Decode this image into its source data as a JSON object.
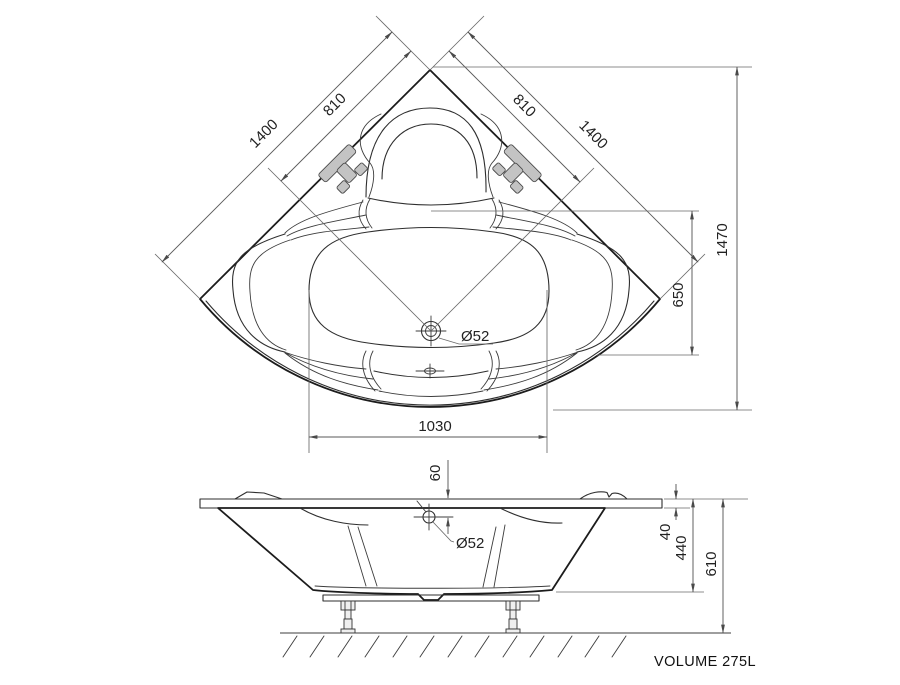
{
  "drawing": {
    "title": "corner bathtub technical drawing",
    "top_view": {
      "dim_edge_full": "1400",
      "dim_edge_drain": "810",
      "dim_overall_depth": "1470",
      "dim_drain_vertical": "650",
      "dim_basin_width": "1030",
      "drain_diameter": "Ø52"
    },
    "side_view": {
      "dim_drain_drop": "60",
      "drain_diameter": "Ø52",
      "dim_rim_thickness": "40",
      "dim_shell_height": "440",
      "dim_total_height": "610",
      "volume_label": "VOLUME 275L"
    },
    "colors": {
      "shell_fill": "#e8eaea",
      "outline": "#1c1c1c",
      "dimension_lines": "#5a5a5a",
      "handle_fill": "#c3c3c3",
      "background": "#ffffff"
    }
  }
}
